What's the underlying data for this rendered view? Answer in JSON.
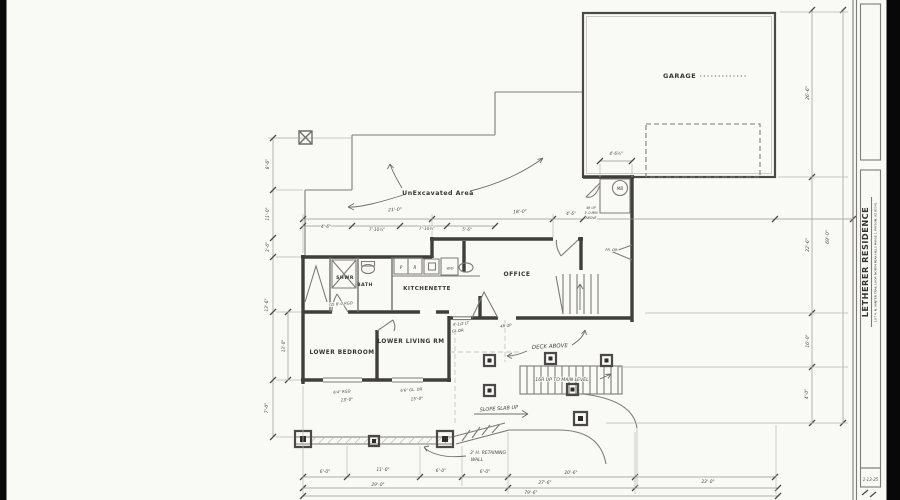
{
  "sheet": {
    "title": "LETHERER RESIDENCE",
    "subtitle": "LOT 4, N. WINTER TRAIL LOOP, NORTH PEAK HILLS PHASE 1, PAYSON, AZ 85541",
    "date": "1-13-25"
  },
  "rooms": {
    "garage": "GARAGE",
    "office": "OFFICE",
    "kitchenette": "KITCHENETTE",
    "bath": "BATH",
    "shower": "SHWR",
    "lower_bedroom": "LOWER BEDROOM",
    "lower_living": "LOWER LIVING RM"
  },
  "labels": {
    "unexcavated": "UnExcavated Area",
    "deck_above": "DECK ABOVE",
    "stair_main": "16R UP TO MAIN LEVEL",
    "slope": "SLOPE SLAB UP",
    "retaining_1": "3' H. RETAINING",
    "retaining_2": "WALL",
    "mb": "MB",
    "p": "P",
    "r": "R",
    "wd": "W/D",
    "fr_dr": "FR. DR.",
    "glass_door_1": "4'-1/2 LT",
    "glass_door_2": "GL.DR",
    "riser_note": "4R UP",
    "hall_note_1": "4R UP",
    "hall_note_2": "3'-0 MIN",
    "hall_note_3": "ABOVE",
    "kit_note": "(2) 8'-0 RGD",
    "bed_window": "6'4\" RGD",
    "bed_width": "13'-0\"",
    "living_door": "6'6\" GL. DR.",
    "living_width": "15'-0\""
  },
  "dims": {
    "top": [
      "21'-0\"",
      "18'-0\"",
      "4'-6\"",
      "7'-10½\"",
      "7'-10½\"",
      "5'-6\"",
      "4'-6\"",
      "4'-6½\""
    ],
    "left": [
      "8'-6\"",
      "11'-0\"",
      "3'-6\"",
      "13'-6\"",
      "7'-0\"",
      "13'-0\""
    ],
    "right": [
      "26'-6\"",
      "22'-6\"",
      "16'-0\"",
      "4'-0\"",
      "69'-0\""
    ],
    "bottom": [
      "6'-0\"",
      "11'-0\"",
      "6'-0\"",
      "6'-0\"",
      "20'-6\"",
      "29'-0\"",
      "27'-6\"",
      "23'-0\"",
      "79'-6\""
    ]
  },
  "colors": {
    "paper": "#f9f9f6",
    "ink": "#3f3e3c"
  }
}
